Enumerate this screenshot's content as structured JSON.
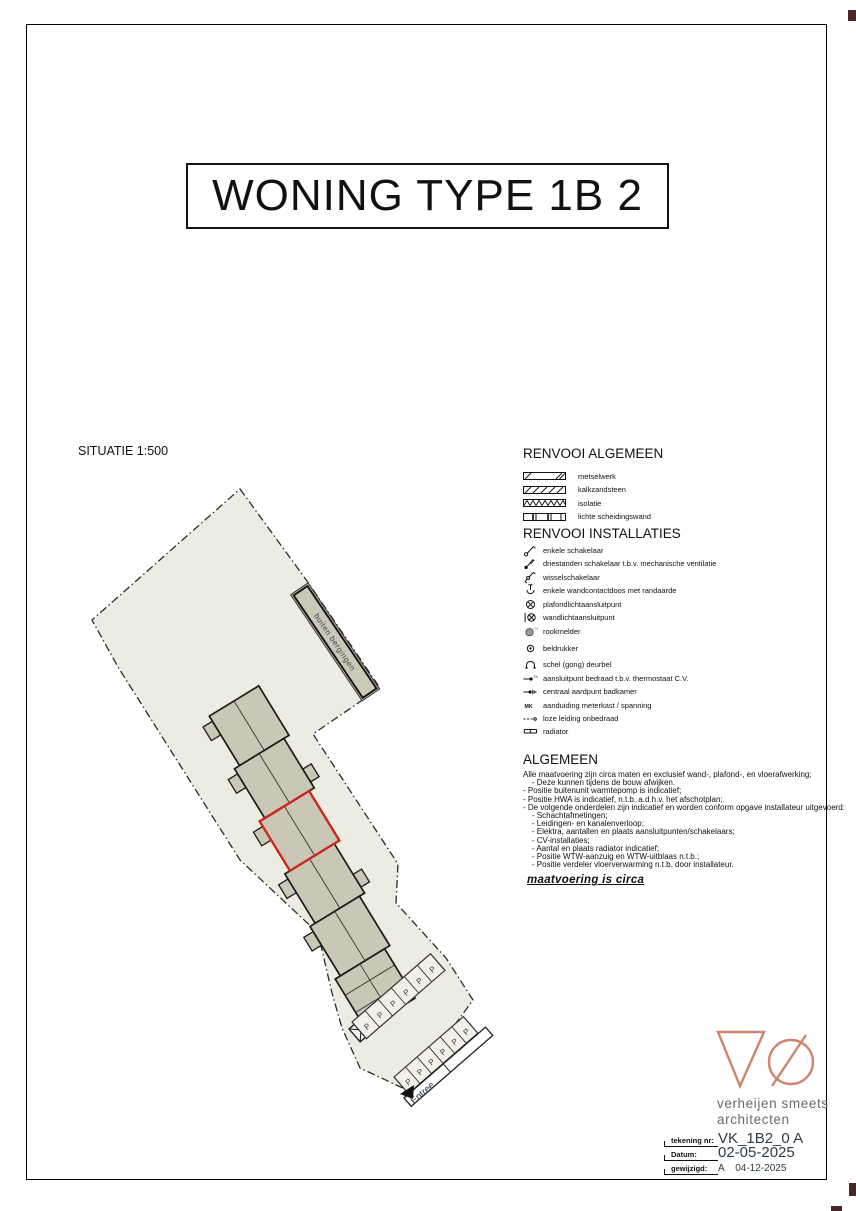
{
  "page": {
    "title": "WONING TYPE 1B 2",
    "situatie_label": "SITUATIE 1:500"
  },
  "legend_general": {
    "heading": "RENVOOI ALGEMEEN",
    "items": [
      {
        "icon": "masonry-hatch-icon",
        "label": "metselwerk"
      },
      {
        "icon": "diagonal-hatch-icon",
        "label": "kalkzandsteen"
      },
      {
        "icon": "zigzag-hatch-icon",
        "label": "isolatie"
      },
      {
        "icon": "segmented-wall-icon",
        "label": "lichte scheidingswand"
      }
    ]
  },
  "legend_installations": {
    "heading": "RENVOOI INSTALLATIES",
    "items": [
      {
        "icon": "single-switch-icon",
        "label": "enkele schakelaar"
      },
      {
        "icon": "three-position-switch-icon",
        "label": "driestanden schakelaar t.b.v. mechanische ventilatie"
      },
      {
        "icon": "two-way-switch-icon",
        "label": "wisselschakelaar"
      },
      {
        "icon": "wall-socket-earthed-icon",
        "label": "enkele wandcontactdoos met randaarde"
      },
      {
        "icon": "ceiling-light-point-icon",
        "label": "plafondlichtaansluitpunt"
      },
      {
        "icon": "wall-light-point-icon",
        "label": "wandlichtaansluitpunt"
      },
      {
        "icon": "smoke-detector-icon",
        "label": "rookmelder"
      },
      {
        "icon": "bell-push-icon",
        "label": "beldrukker"
      },
      {
        "icon": "doorbell-gong-icon",
        "label": "schel (gong) deurbel"
      },
      {
        "icon": "thermostat-connection-icon",
        "label": "aansluitpunt bedraad t.b.v. thermostaat C.V."
      },
      {
        "icon": "earth-point-icon",
        "label": "centraal aardpunt badkamer"
      },
      {
        "icon": "meter-cupboard-icon",
        "label": "aanduiding meterkast / spanning"
      },
      {
        "icon": "unwired-conduit-icon",
        "label": "loze leiding onbedraad"
      },
      {
        "icon": "radiator-icon",
        "label": "radiator"
      }
    ]
  },
  "algemeen": {
    "heading": "ALGEMEEN",
    "lines": [
      "Alle maatvoering zijn circa maten en exclusief wand-, plafond-, en vloerafwerking;",
      "    - Deze kunnen tijdens de bouw afwijken.",
      "- Positie buitenunit warmtepomp is indicatief;",
      "- Positie HWA is indicatief, n.t.b. a.d.h.v. het afschotplan;",
      "- De volgende onderdelen zijn indicatief en worden conform opgave installateur uitgevoerd:",
      "    - Schachtafmetingen;",
      "    - Leidingen- en kanalenverloop;",
      "    - Elektra, aantallen en plaats aansluitpunten/schakelaars;",
      "    - CV-installaties;",
      "    - Aantal en plaats radiator indicatief;",
      "    - Positie WTW-aanzuig en WTW-uitblaas n.t.b.;",
      "    - Positie verdeler vloerverwarming n.t.b. door installateur."
    ],
    "note": "maatvoering is circa"
  },
  "siteplan": {
    "buiten_bergingen_label": "buiten bergingen",
    "parking_letter": "P",
    "entree_label": "Entree"
  },
  "titleblock": {
    "firm_line1": "verheijen smeets",
    "firm_line2": "architecten",
    "rows": [
      {
        "label": "tekening nr:",
        "value": "VK_1B2_0 A"
      },
      {
        "label": "Datum:",
        "value": "02-05-2025"
      },
      {
        "label": "gewijzigd:",
        "value": "A    04-12-2025"
      }
    ]
  },
  "colors": {
    "site_fill": "#edece3",
    "building_fill": "#cbc7b6",
    "highlight_red": "#c9271c",
    "logo_coral": "#cd8470",
    "plan_text": "#35444f",
    "firm_gray": "#6a6a6a"
  }
}
